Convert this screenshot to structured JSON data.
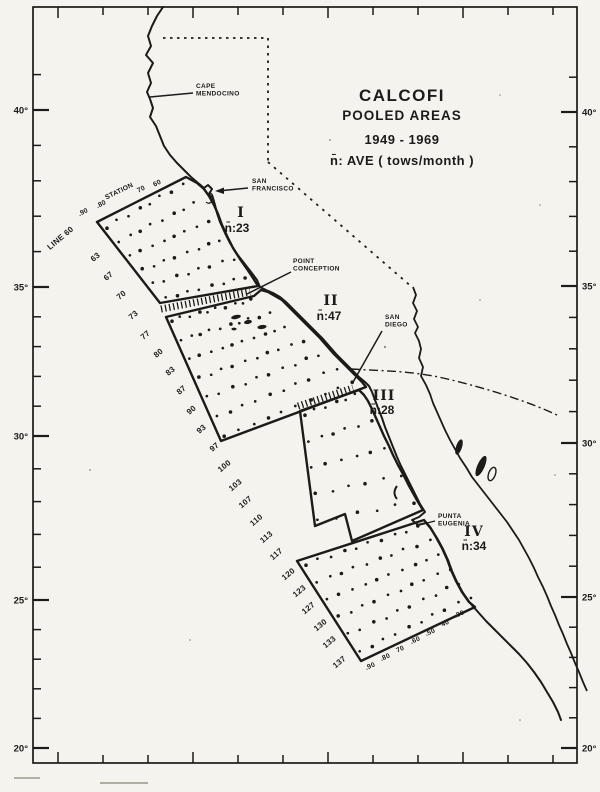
{
  "colors": {
    "ink": "#1c1b18",
    "paper": "#f5f3ee"
  },
  "title": {
    "lines": [
      "CALCOFI",
      "POOLED AREAS",
      "1949 - 1969",
      "n̄: AVE ( tows/month )"
    ]
  },
  "latitude_axis": {
    "left": [
      {
        "label": "40°",
        "y": 110
      },
      {
        "label": "35°",
        "y": 287
      },
      {
        "label": "30°",
        "y": 436
      },
      {
        "label": "25°",
        "y": 600
      },
      {
        "label": "20°",
        "y": 748
      }
    ],
    "right": [
      {
        "label": "40°",
        "y": 112
      },
      {
        "label": "35°",
        "y": 286
      },
      {
        "label": "30°",
        "y": 443
      },
      {
        "label": "25°",
        "y": 597
      },
      {
        "label": "20°",
        "y": 748
      }
    ]
  },
  "calcofi_lines": [
    {
      "label": "LINE 60",
      "x": 62,
      "y": 240
    },
    {
      "label": "63",
      "x": 97,
      "y": 259
    },
    {
      "label": "67",
      "x": 110,
      "y": 278
    },
    {
      "label": "70",
      "x": 123,
      "y": 297
    },
    {
      "label": "73",
      "x": 135,
      "y": 317
    },
    {
      "label": "77",
      "x": 147,
      "y": 337
    },
    {
      "label": "80",
      "x": 160,
      "y": 355
    },
    {
      "label": "83",
      "x": 172,
      "y": 373
    },
    {
      "label": "87",
      "x": 183,
      "y": 392
    },
    {
      "label": "90",
      "x": 193,
      "y": 412
    },
    {
      "label": "93",
      "x": 203,
      "y": 431
    },
    {
      "label": "97",
      "x": 216,
      "y": 449
    },
    {
      "label": "100",
      "x": 226,
      "y": 468
    },
    {
      "label": "103",
      "x": 237,
      "y": 487
    },
    {
      "label": "107",
      "x": 247,
      "y": 504
    },
    {
      "label": "110",
      "x": 258,
      "y": 522
    },
    {
      "label": "113",
      "x": 268,
      "y": 539
    },
    {
      "label": "117",
      "x": 278,
      "y": 556
    },
    {
      "label": "120",
      "x": 290,
      "y": 576
    },
    {
      "label": "123",
      "x": 301,
      "y": 593
    },
    {
      "label": "127",
      "x": 310,
      "y": 610
    },
    {
      "label": "130",
      "x": 322,
      "y": 627
    },
    {
      "label": "133",
      "x": 331,
      "y": 644
    },
    {
      "label": "137",
      "x": 341,
      "y": 664
    }
  ],
  "stations": {
    "caption": "STATION",
    "caption_x": 120,
    "caption_y": 193,
    "top": [
      {
        "label": ".90",
        "x": 84,
        "y": 214
      },
      {
        "label": ".80",
        "x": 102,
        "y": 206
      },
      {
        "label": "70",
        "x": 142,
        "y": 191
      },
      {
        "label": "60",
        "x": 158,
        "y": 185
      }
    ],
    "bottom": [
      {
        "label": ".90",
        "x": 371,
        "y": 668
      },
      {
        "label": ".80",
        "x": 386,
        "y": 659
      },
      {
        "label": "70",
        "x": 401,
        "y": 651
      },
      {
        "label": ".60",
        "x": 416,
        "y": 642
      },
      {
        "label": ".50",
        "x": 431,
        "y": 634
      },
      {
        "label": "40",
        "x": 446,
        "y": 625
      },
      {
        "label": ".30",
        "x": 460,
        "y": 616
      }
    ]
  },
  "places": [
    {
      "id": "cape-mendocino",
      "lines": [
        "CAPE",
        "MENDOCINO"
      ],
      "x": 196,
      "y": 88
    },
    {
      "id": "san-francisco",
      "lines": [
        "SAN",
        "FRANCISCO"
      ],
      "x": 252,
      "y": 183
    },
    {
      "id": "point-conception",
      "lines": [
        "POINT",
        "CONCEPTION"
      ],
      "x": 293,
      "y": 263
    },
    {
      "id": "san-diego",
      "lines": [
        "SAN",
        "DIEGO"
      ],
      "x": 385,
      "y": 319
    },
    {
      "id": "punta-eugenia",
      "lines": [
        "PUNTA",
        "EUGENIA"
      ],
      "x": 438,
      "y": 518
    }
  ],
  "areas": [
    {
      "id": "I",
      "numeral": "I",
      "avg": "n̄:23",
      "nx": 241,
      "ny": 217,
      "ax": 237,
      "ay": 232,
      "grid": {
        "tl": [
          107,
          227
        ],
        "tr": [
          182,
          185
        ],
        "br": [
          246,
          277
        ],
        "bl": [
          165,
          298
        ],
        "rows": 6,
        "cols": 8
      }
    },
    {
      "id": "II",
      "numeral": "II",
      "avg": "n̄:47",
      "nx": 331,
      "ny": 305,
      "ax": 329,
      "ay": 320,
      "grid": {
        "tl": [
          172,
          320
        ],
        "tr": [
          252,
          300
        ],
        "br": [
          353,
          382
        ],
        "bl": [
          225,
          436
        ],
        "rows": 7,
        "cols": 10
      }
    },
    {
      "id": "III",
      "numeral": "III",
      "avg": "n̄:28",
      "nx": 384,
      "ny": 400,
      "ax": 382,
      "ay": 414,
      "grid": {
        "tl": [
          305,
          414
        ],
        "tr": [
          356,
          395
        ],
        "br": [
          415,
          502
        ],
        "bl": [
          318,
          521
        ],
        "rows": 5,
        "cols": 6
      }
    },
    {
      "id": "IV",
      "numeral": "IV",
      "avg": "n̄:34",
      "nx": 474,
      "ny": 536,
      "ax": 474,
      "ay": 550,
      "grid": {
        "tl": [
          306,
          564
        ],
        "tr": [
          419,
          527
        ],
        "br": [
          470,
          597
        ],
        "bl": [
          359,
          652
        ],
        "rows": 6,
        "cols": 10
      }
    }
  ]
}
